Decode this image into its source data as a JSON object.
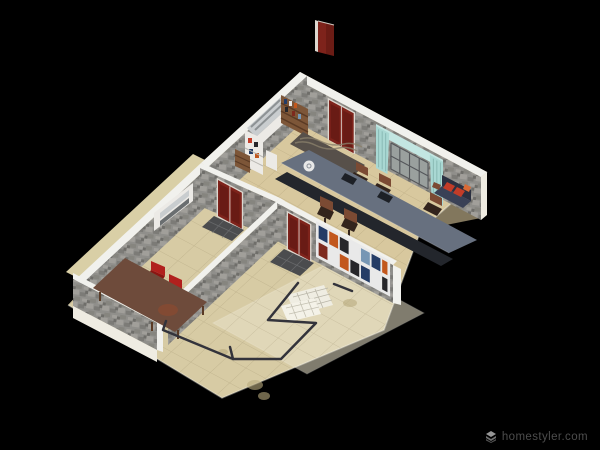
{
  "app": {
    "name": "Homestyler",
    "watermark": {
      "text": "homestyler.com",
      "icon": "layers-logo-icon"
    }
  },
  "scene": {
    "type": "3d-floor-plan-render",
    "camera": "elevated-oblique-view",
    "background": "black-void",
    "floating_objects": [
      {
        "name": "detached-red-door",
        "location": "floating-above-plan-top-center"
      }
    ],
    "rooms": [
      {
        "name": "meeting-room",
        "position": "upper-right",
        "walls": "gray-stone-texture",
        "items": [
          "red-double-entry-door",
          "window-with-cyan-curtains",
          "range-hood-counter",
          "tall-white-cabinet",
          "wood-bookshelf",
          "small-wood-shelf",
          "striped-area-rug",
          "long-conference-table",
          "white-plate",
          "laptop",
          "laptop",
          "office-chair",
          "office-chair",
          "office-chair",
          "office-chair",
          "office-chair",
          "navy-sofa-with-red-cushions",
          "small-brown-object",
          "interior-red-door",
          "dark-door-mat",
          "colorful-wall-display-shelf"
        ]
      },
      {
        "name": "dining-room",
        "position": "left",
        "walls": "gray-stone-texture",
        "items": [
          "wood-dining-table",
          "red-chair",
          "red-chair",
          "white-wall-cabinet",
          "interior-red-door",
          "dark-door-mat"
        ]
      },
      {
        "name": "open-floor-area",
        "position": "bottom",
        "walls": "none-open-slab",
        "items": [
          "fallen-clothes-drying-rack",
          "floor-stains",
          "light-floor-panel"
        ]
      }
    ]
  },
  "colors": {
    "bg": "#000000",
    "floor": "#d7cba4",
    "floor_room": "#d8c79b",
    "floor_light": "#e9e2c9",
    "floor_tan": "#d9cfa6",
    "slab_edge": "#efece2",
    "wall_top": "#f1f1ed",
    "stone_a": "#908f8b",
    "stone_b": "#a19f9a",
    "stone_c": "#7c7b77",
    "stone_d": "#86857f",
    "stone_e": "#6f6e6a",
    "door_red": "#7e231b",
    "door_red_dark": "#571510",
    "door_frame": "#ddd8d0",
    "curtain": "#a9d8d3",
    "valance": "#c3e6e2",
    "pane": "#9aa09e",
    "mullion": "#54565a",
    "table_top": "#67707f",
    "table_base": "#23262c",
    "plate": "#e8e8e8",
    "laptop": "#1d2026",
    "chair_brown": "#7b4a33",
    "chair_brown_dark": "#33241c",
    "sofa_dark": "#2b3040",
    "sofa_seat": "#3a4156",
    "cushion_red": "#c23c28",
    "cushion_orange": "#d96a35",
    "dining_table": "#6e4b3b",
    "dining_stain": "#8a4a30",
    "chair_red": "#b1201d",
    "chair_red_dark": "#8c1512",
    "wood_shelf": "#7d5638",
    "wood_dark": "#5a3a24",
    "cabinet_white": "#eceae6",
    "steel": "#c9cdcf",
    "mat": "#4b4c4e",
    "mat_line": "#7a7b7d",
    "rug": "#57504a",
    "rug_wave": "#8a7f6a",
    "rack": "#33333b",
    "rack_panel": "#efede2",
    "stain": "#b9ab7e",
    "cell_navy": "#243c66",
    "cell_orange": "#c2571d",
    "cell_white": "#e9e9e9",
    "cell_black": "#26262a",
    "cell_blue": "#7696b4",
    "cell_maroon": "#7e2a1e",
    "watermark_text": "#4d4d4d",
    "watermark_icon": "#969696"
  }
}
